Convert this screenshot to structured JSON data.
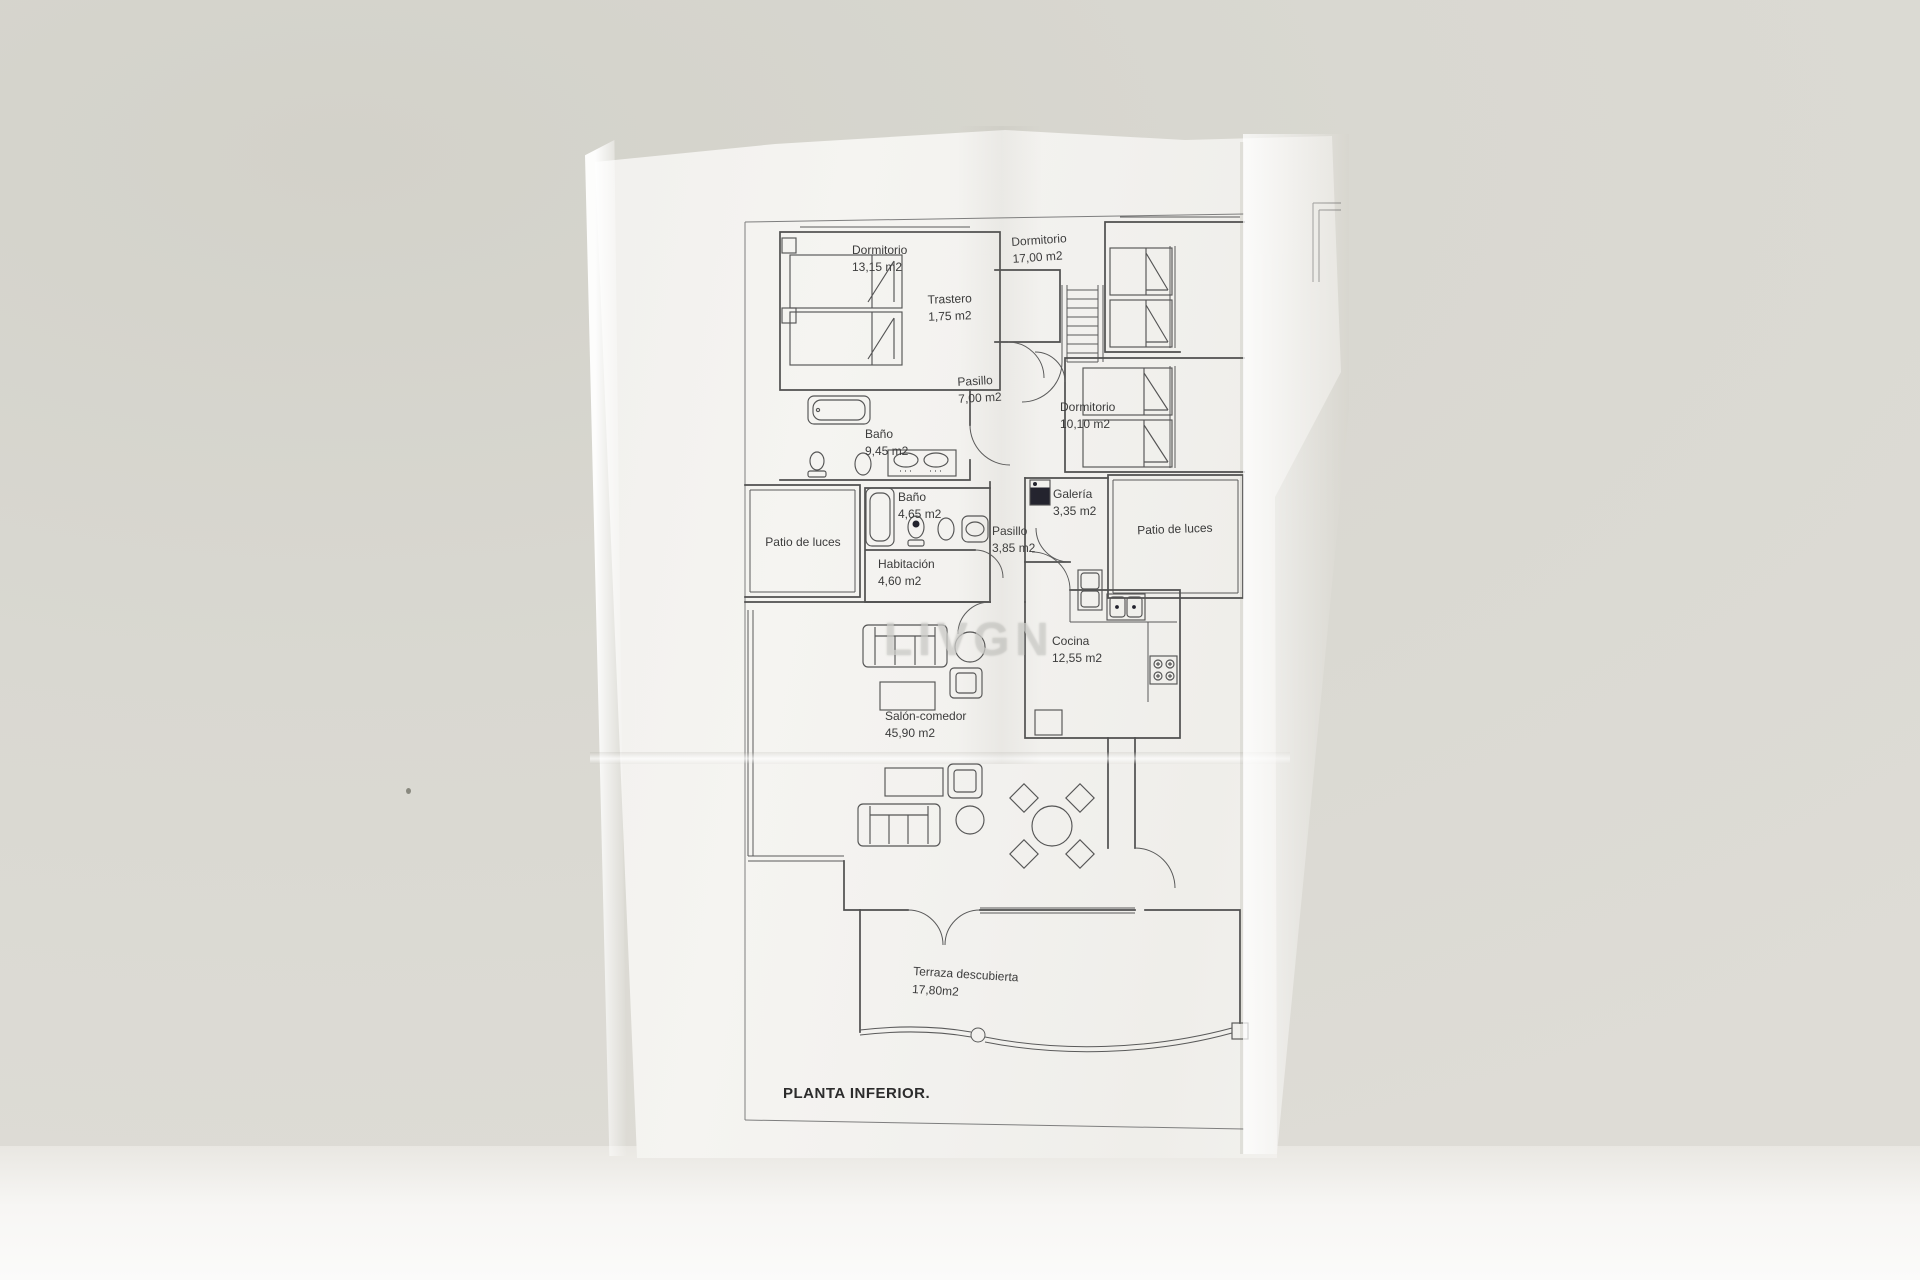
{
  "photo": {
    "background_color": "#d8d7d0",
    "paper_color": "#f4f3f0",
    "line_color": "#4f4f4f",
    "watermark_text": "LIVGN"
  },
  "plan": {
    "footer_label": "PLANTA INFERIOR.",
    "rooms": [
      {
        "name": "Dormitorio",
        "area": "13,15 m2"
      },
      {
        "name": "Dormitorio",
        "area": "17,00 m2"
      },
      {
        "name": "Trastero",
        "area": "1,75 m2"
      },
      {
        "name": "Pasillo",
        "area": "7,00 m2"
      },
      {
        "name": "Dormitorio",
        "area": "10,10 m2"
      },
      {
        "name": "Baño",
        "area": "9,45 m2"
      },
      {
        "name": "Baño",
        "area": "4,65 m2"
      },
      {
        "name": "Patio de luces",
        "area": ""
      },
      {
        "name": "Habitación",
        "area": "4,60 m2"
      },
      {
        "name": "Pasillo",
        "area": "3,85 m2"
      },
      {
        "name": "Galería",
        "area": "3,35 m2"
      },
      {
        "name": "Patio de luces",
        "area": ""
      },
      {
        "name": "Cocina",
        "area": "12,55 m2"
      },
      {
        "name": "Salón-comedor",
        "area": "45,90 m2"
      },
      {
        "name": "Terraza descubierta",
        "area": "17,80m2"
      }
    ]
  }
}
